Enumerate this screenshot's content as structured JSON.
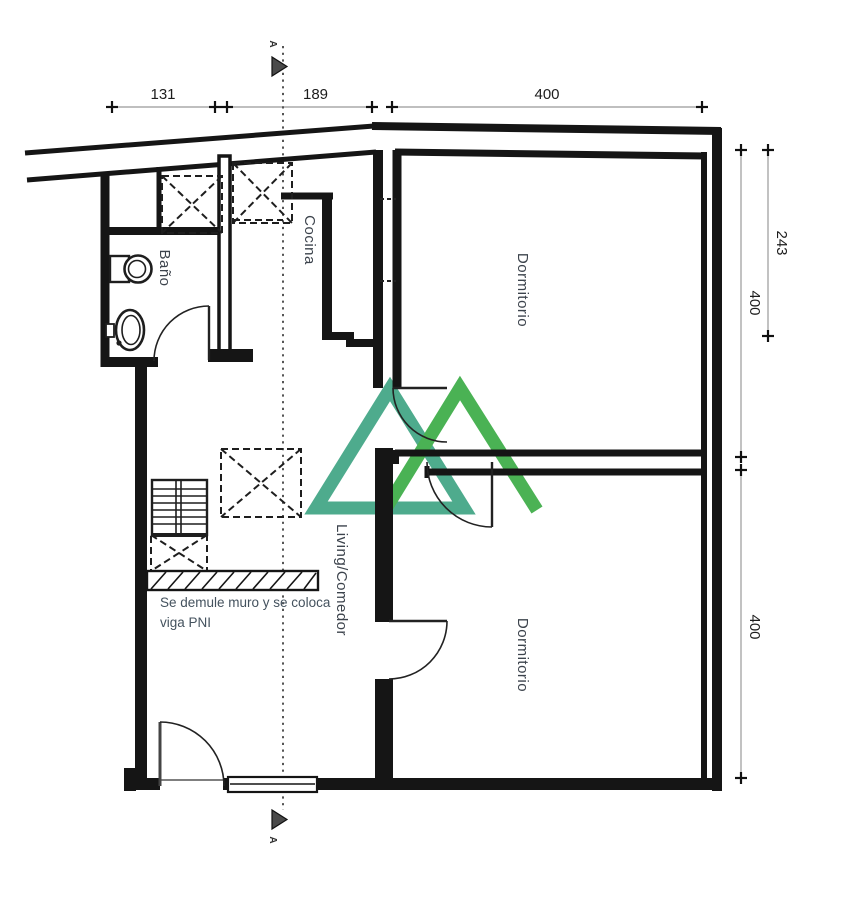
{
  "plan": {
    "rooms": {
      "bathroom": "Baño",
      "kitchen": "Cocina",
      "bedroom_top": "Dormitorio",
      "bedroom_bottom": "Dormitorio",
      "living": "Living/Comedor"
    },
    "note_line1": "Se demule muro y se coloca",
    "note_line2": "viga PNI",
    "section_label": "A"
  },
  "dimensions": {
    "top_left": "131",
    "top_mid": "189",
    "top_right": "400",
    "right_depth": "243",
    "right_upper": "400",
    "right_lower": "400"
  },
  "colors": {
    "wall": "#151515",
    "dim_line": "#999999",
    "logo_left": "#45a787",
    "logo_right": "#41ae4b"
  }
}
